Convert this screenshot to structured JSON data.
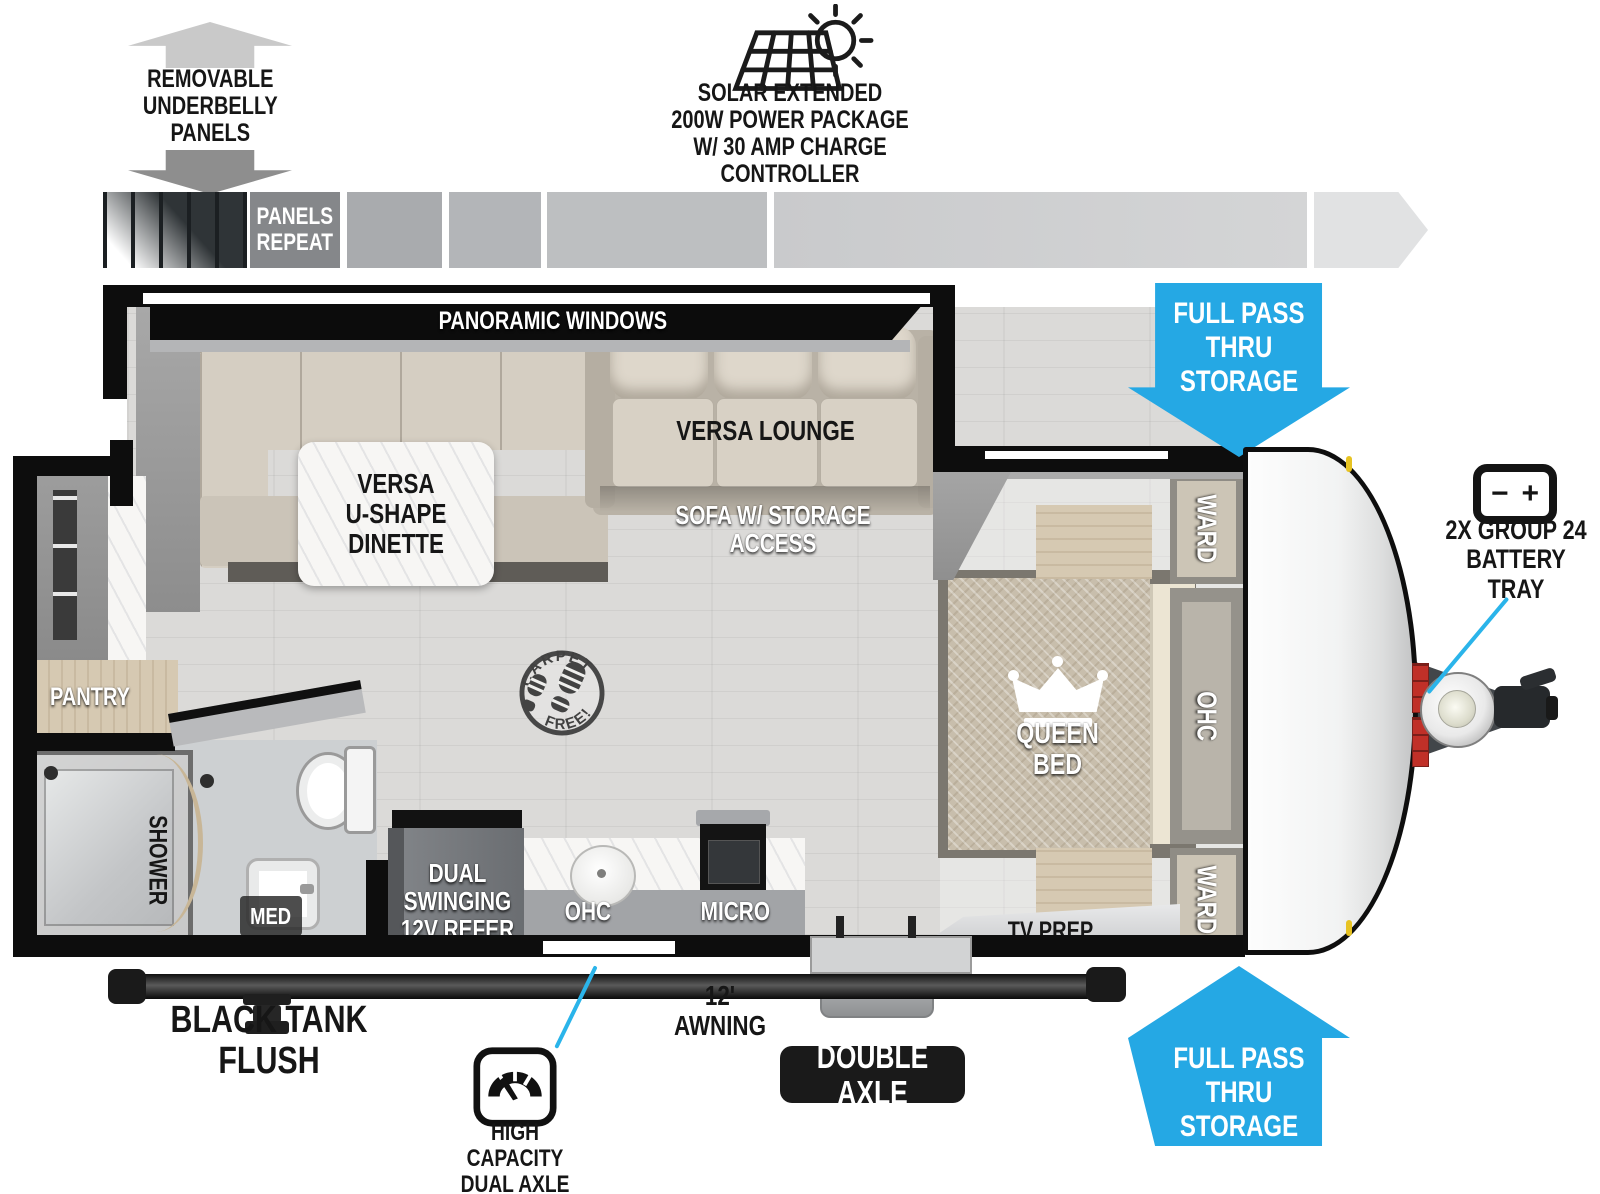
{
  "colors": {
    "accent_blue": "#25a8e4",
    "callout_cyan": "#2ab4ea",
    "battery_red": "#c03028",
    "marker_yellow": "#e7c322"
  },
  "callouts": {
    "underbelly": "REMOVABLE\nUNDERBELLY\nPANELS",
    "solar": "SOLAR EXTENDED\n200W POWER PACKAGE\nW/ 30 AMP CHARGE CONTROLLER",
    "panels_repeat": "PANELS\nREPEAT",
    "storage_top": "FULL PASS\nTHRU\nSTORAGE",
    "storage_bottom": "FULL PASS\nTHRU\nSTORAGE",
    "battery": "2X GROUP 24\nBATTERY TRAY",
    "battery_minus": "−",
    "battery_plus": "+",
    "black_tank": "BLACK TANK FLUSH",
    "awning": "12' AWNING",
    "double_axle": "DOUBLE AXLE",
    "high_capacity": "HIGH CAPACITY\nDUAL AXLE"
  },
  "rooms": {
    "panoramic_windows": "PANORAMIC WINDOWS",
    "dinette": "VERSA\nU-SHAPE\nDINETTE",
    "lounge": "VERSA LOUNGE",
    "sofa_storage": "SOFA W/ STORAGE ACCESS",
    "pantry": "PANTRY",
    "shower": "SHOWER",
    "med": "MED",
    "refer": "DUAL SWINGING\n12V REFER",
    "ohc_kitchen": "OHC",
    "micro": "MICRO",
    "ward_top": "WARD",
    "ohc_bed": "OHC",
    "ward_bottom": "WARD",
    "queen_bed": "QUEEN BED",
    "tv_prep": "TV PREP",
    "carpet_free_top": "CARPET",
    "carpet_free_bottom": "FREE!"
  }
}
